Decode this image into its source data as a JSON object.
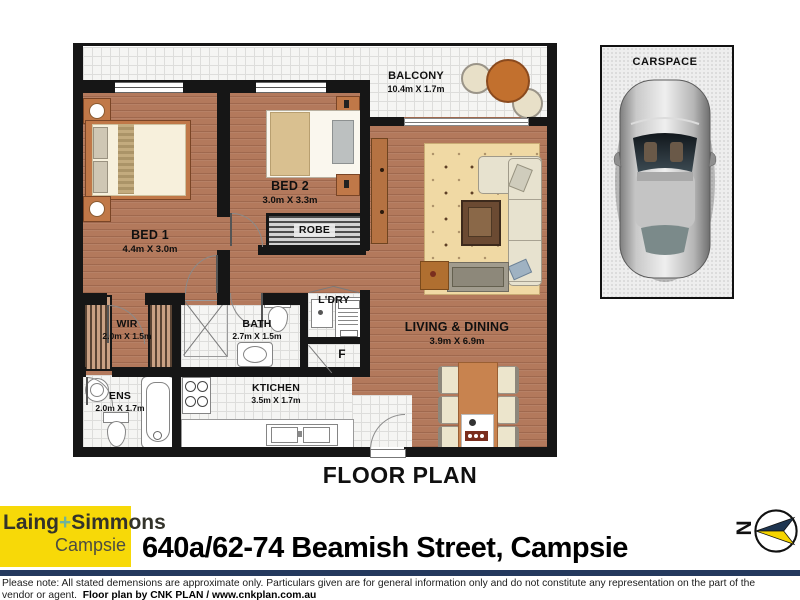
{
  "plan": {
    "title": "FLOOR PLAN",
    "rooms": {
      "balcony": {
        "label": "BALCONY",
        "dims": "10.4m X 1.7m"
      },
      "bed1": {
        "label": "BED 1",
        "dims": "4.4m X 3.0m"
      },
      "bed2": {
        "label": "BED 2",
        "dims": "3.0m X 3.3m"
      },
      "robe": {
        "label": "ROBE"
      },
      "wir": {
        "label": "WIR",
        "dims": "2.0m X 1.5m"
      },
      "bath": {
        "label": "BATH",
        "dims": "2.7m X 1.5m"
      },
      "laundry": {
        "label": "L'DRY"
      },
      "fridge": {
        "label": "F"
      },
      "ens": {
        "label": "ENS",
        "dims": "2.0m X 1.7m"
      },
      "kitchen": {
        "label": "KTICHEN",
        "dims": "3.5m X 1.7m"
      },
      "living": {
        "label": "LIVING & DINING",
        "dims": "3.9m X 6.9m"
      }
    },
    "carspace": {
      "label": "CARSPACE"
    },
    "compass": {
      "label": "N"
    }
  },
  "footer": {
    "agency": {
      "name_left": "Laing",
      "plus": "+",
      "name_right": "Simmons",
      "branch": "Campsie"
    },
    "address": "640a/62-74 Beamish Street, Campsie",
    "disclaimer_line1": "Please note: All stated demensions are approximate only. Particulars given are for general information only and do not constitute any representation on the part of the",
    "disclaimer_line2_prefix": "vendor or agent.",
    "credit": "Floor plan by CNK PLAN / www.cnkplan.com.au"
  },
  "colors": {
    "wood_floor": "#b3795c",
    "wall_black": "#161616",
    "tile_white": "#f5f5f3",
    "logo_yellow": "#f7d908",
    "logo_plus_teal": "#6fb39c",
    "divider_navy": "#24395e",
    "compass_navy": "#1e3550",
    "compass_yellow": "#f5d400"
  }
}
